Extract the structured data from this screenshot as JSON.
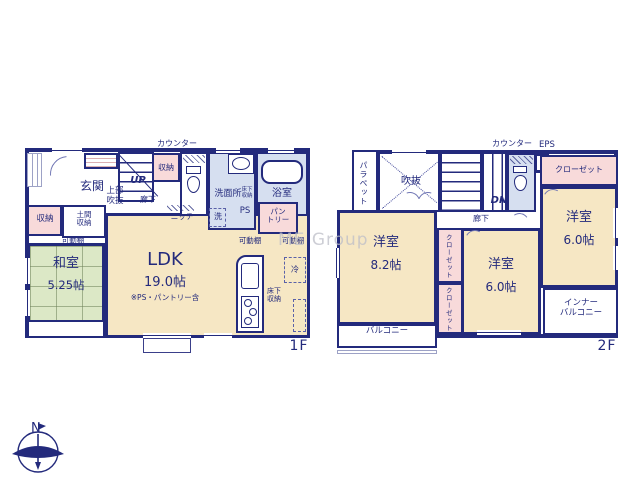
{
  "watermark": "ME Group",
  "compass": {
    "north": "N"
  },
  "colors": {
    "wall": "#232a7c",
    "room_cream": "#f6e7c4",
    "tatami_green": "#dce8c6",
    "storage_pink": "#f8dada",
    "wet_blue": "#d6dff0"
  },
  "f1": {
    "floor_label": "1F",
    "labels": {
      "counter": "カウンター",
      "entrance": "玄関",
      "upper_void_1": "上部",
      "upper_void_2": "吹抜",
      "up": "UP",
      "hallway": "廊下",
      "storage_top": "収納",
      "washroom": "洗面所",
      "washroom_underfloor_1": "床下",
      "washroom_underfloor_2": "収納",
      "bathroom": "浴室",
      "washer": "洗",
      "ps": "PS",
      "pantry_1": "パン",
      "pantry_2": "トリー",
      "niche": "ニッチ",
      "storage_left": "収納",
      "doma_1": "土間",
      "doma_2": "収納",
      "shelf_left": "可動棚",
      "shelf_mid": "可動棚",
      "shelf_right": "可動棚",
      "tatami_room": "和室",
      "tatami_size": "5.25帖",
      "ldk": "LDK",
      "ldk_size": "19.0帖",
      "ldk_note": "※PS・パントリー含",
      "fridge": "冷",
      "kitchen_underfloor_1": "床下",
      "kitchen_underfloor_2": "収納"
    }
  },
  "f2": {
    "floor_label": "2F",
    "labels": {
      "counter": "カウンター",
      "eps": "EPS",
      "parapet": "パラペット",
      "void": "吹抜",
      "dn": "DN",
      "hallway": "廊下",
      "closet_right": "クローゼット",
      "bedroom_right": "洋室",
      "bedroom_right_size": "6.0帖",
      "inner_balcony_1": "インナー",
      "inner_balcony_2": "バルコニー",
      "bedroom_left": "洋室",
      "bedroom_left_size": "8.2帖",
      "closet_mid_upper": "クローゼット",
      "closet_mid_lower": "クローゼット",
      "bedroom_mid": "洋室",
      "bedroom_mid_size": "6.0帖",
      "balcony": "バルコニー"
    }
  }
}
